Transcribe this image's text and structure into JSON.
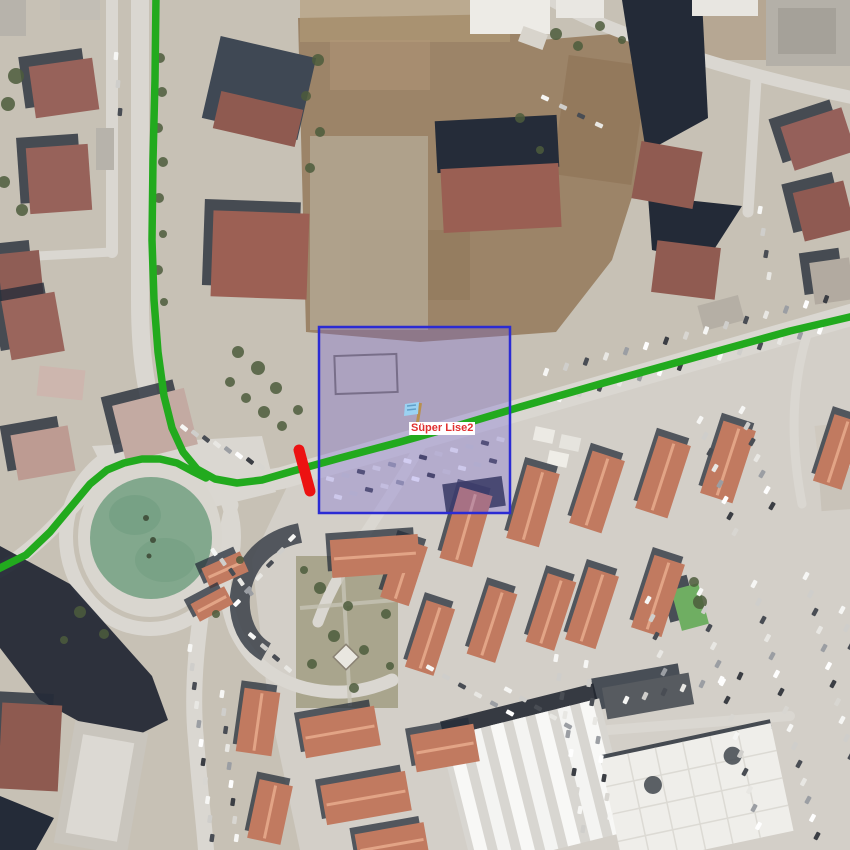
{
  "map": {
    "marker": {
      "label_text": "Süper Lise2",
      "label_text_color": "#e03030",
      "label_bg_color": "#ffffff",
      "flag_color": "#9bd2f2",
      "flag_shade_color": "#5f9fc8",
      "pole_color": "#b8904e"
    },
    "route": {
      "color": "#22aa1e",
      "width": 7.5,
      "main_points": "156,-4 155,80 153,160 152,240 154,300 158,352 164,396 172,428 183,452 197,469 215,479 237,483 262,480 293,471 340,458 400,442 460,425 520,407 600,384 700,356 790,331 854,316",
      "branch_points": "-4,570 26,555 50,532 70,508 90,484 107,470 124,463 142,459 160,459 177,463 192,471 206,478"
    },
    "selection_box": {
      "x": 319,
      "y": 327,
      "width": 191,
      "height": 186,
      "border_color": "#2b2bd4",
      "border_width": 2.5,
      "fill_color": "rgba(108,94,214,0.30)"
    },
    "blocked_segment": {
      "x1": 299,
      "y1": 450,
      "x2": 310,
      "y2": 491,
      "color": "#ec1212",
      "width": 11
    },
    "pond_color": "#82a88d"
  },
  "scene": {
    "shadow_color": "#262d3a",
    "tree_color": "#4c5c3c",
    "townhouse_color": "#c17a60",
    "townhouse_ridge_color": "#e2a486",
    "car_colors": [
      "#f6f6f4",
      "#cfcecb",
      "#494d54",
      "#e8e7e3",
      "#9b9ea3",
      "#fefefe",
      "#3b3e44",
      "#d8d6d1"
    ],
    "buildings": [
      [
        32,
        62,
        64,
        52,
        -8,
        "#97625a",
        1
      ],
      [
        28,
        146,
        62,
        66,
        -4,
        "#97625a",
        1
      ],
      [
        0,
        252,
        42,
        58,
        -6,
        "#8f5d55",
        1
      ],
      [
        6,
        296,
        54,
        60,
        -10,
        "#9a655c",
        1
      ],
      [
        96,
        128,
        18,
        42,
        0,
        "#b7b3ab",
        0
      ],
      [
        0,
        0,
        26,
        36,
        0,
        "#b7b3ab",
        0
      ],
      [
        60,
        0,
        40,
        20,
        0,
        "#c2beb5",
        0
      ],
      [
        210,
        46,
        98,
        84,
        13,
        "#3f4854",
        0
      ],
      [
        216,
        100,
        84,
        38,
        13,
        "#8f5a50",
        0
      ],
      [
        212,
        212,
        96,
        86,
        2,
        "#9c6054",
        1
      ],
      [
        436,
        118,
        122,
        52,
        -3,
        "#252c39",
        0
      ],
      [
        442,
        166,
        118,
        64,
        -3,
        "#9a5f53",
        0
      ],
      [
        470,
        0,
        80,
        34,
        0,
        "#edebe6",
        0
      ],
      [
        556,
        0,
        48,
        18,
        0,
        "#e9e7e2",
        0
      ],
      [
        692,
        0,
        66,
        16,
        0,
        "#e8e6e1",
        0
      ],
      [
        520,
        30,
        26,
        16,
        20,
        "#d8d4cc",
        0
      ],
      [
        766,
        0,
        84,
        66,
        0,
        "#b4b0a8",
        0
      ],
      [
        778,
        8,
        58,
        46,
        0,
        "#a5a199",
        0
      ],
      [
        636,
        146,
        62,
        58,
        10,
        "#905b51",
        0
      ],
      [
        654,
        244,
        64,
        52,
        7,
        "#905b51",
        0
      ],
      [
        786,
        116,
        64,
        46,
        -18,
        "#95605a",
        1
      ],
      [
        798,
        186,
        52,
        50,
        -14,
        "#8f5a52",
        1
      ],
      [
        812,
        260,
        40,
        42,
        -8,
        "#b2aaa0",
        1
      ],
      [
        816,
        424,
        36,
        30,
        -6,
        "#cfc9bf",
        0
      ],
      [
        820,
        468,
        32,
        42,
        -4,
        "#c9c3b9",
        0
      ],
      [
        700,
        300,
        42,
        26,
        -15,
        "#b5afa5",
        0
      ],
      [
        118,
        396,
        74,
        58,
        -14,
        "#c3aaa2",
        1
      ],
      [
        14,
        430,
        58,
        46,
        -10,
        "#bd9b92",
        1
      ],
      [
        38,
        368,
        46,
        30,
        6,
        "#cdb6ae",
        0
      ],
      [
        0,
        704,
        60,
        86,
        3,
        "#8e5a50",
        1
      ],
      [
        64,
        726,
        74,
        124,
        10,
        "#c9c5bd",
        0
      ],
      [
        74,
        738,
        52,
        100,
        10,
        "#dcd9d3",
        0
      ],
      [
        604,
        680,
        88,
        32,
        -10,
        "#575b60",
        1
      ],
      [
        676,
        586,
        28,
        42,
        -15,
        "#6fae62",
        1
      ],
      [
        444,
        480,
        60,
        30,
        -8,
        "#3a4148",
        0
      ],
      [
        534,
        428,
        20,
        14,
        12,
        "#eceae4",
        0
      ],
      [
        560,
        436,
        20,
        14,
        12,
        "#e6e4de",
        0
      ],
      [
        548,
        452,
        20,
        14,
        12,
        "#efede7",
        0
      ]
    ],
    "townhouses": [
      [
        466,
        527,
        34,
        74,
        16
      ],
      [
        533,
        506,
        34,
        76,
        16
      ],
      [
        597,
        492,
        34,
        76,
        18
      ],
      [
        663,
        477,
        34,
        76,
        18
      ],
      [
        728,
        462,
        34,
        76,
        18
      ],
      [
        838,
        452,
        30,
        70,
        18
      ],
      [
        592,
        608,
        32,
        76,
        18
      ],
      [
        658,
        596,
        32,
        76,
        18
      ],
      [
        404,
        572,
        30,
        62,
        18
      ],
      [
        430,
        638,
        30,
        70,
        18
      ],
      [
        492,
        624,
        30,
        72,
        18
      ],
      [
        551,
        612,
        30,
        72,
        18
      ],
      [
        375,
        556,
        88,
        38,
        -4
      ],
      [
        340,
        732,
        76,
        40,
        -10
      ],
      [
        366,
        798,
        86,
        40,
        -10
      ],
      [
        392,
        845,
        70,
        34,
        -10
      ],
      [
        445,
        748,
        64,
        38,
        -10
      ],
      [
        258,
        722,
        36,
        64,
        8
      ],
      [
        270,
        812,
        34,
        60,
        12
      ],
      [
        225,
        570,
        42,
        22,
        -24
      ],
      [
        212,
        604,
        38,
        20,
        -28
      ]
    ],
    "trees": [
      [
        16,
        76,
        8
      ],
      [
        8,
        104,
        7
      ],
      [
        4,
        182,
        6
      ],
      [
        22,
        210,
        6
      ],
      [
        160,
        58,
        5
      ],
      [
        162,
        92,
        5
      ],
      [
        158,
        128,
        5
      ],
      [
        163,
        162,
        5
      ],
      [
        159,
        198,
        5
      ],
      [
        163,
        234,
        4
      ],
      [
        158,
        270,
        5
      ],
      [
        164,
        302,
        4
      ],
      [
        318,
        60,
        6
      ],
      [
        306,
        96,
        5
      ],
      [
        320,
        132,
        5
      ],
      [
        310,
        168,
        5
      ],
      [
        238,
        352,
        6
      ],
      [
        258,
        368,
        7
      ],
      [
        276,
        388,
        6
      ],
      [
        246,
        398,
        5
      ],
      [
        264,
        412,
        6
      ],
      [
        282,
        426,
        5
      ],
      [
        298,
        410,
        5
      ],
      [
        230,
        382,
        5
      ],
      [
        556,
        34,
        6
      ],
      [
        578,
        46,
        5
      ],
      [
        600,
        26,
        5
      ],
      [
        622,
        40,
        4
      ],
      [
        520,
        118,
        5
      ],
      [
        540,
        150,
        4
      ],
      [
        320,
        588,
        6
      ],
      [
        348,
        606,
        5
      ],
      [
        334,
        636,
        6
      ],
      [
        364,
        650,
        5
      ],
      [
        312,
        664,
        5
      ],
      [
        354,
        688,
        5
      ],
      [
        386,
        614,
        5
      ],
      [
        304,
        570,
        4
      ],
      [
        390,
        666,
        4
      ],
      [
        80,
        612,
        6
      ],
      [
        104,
        634,
        5
      ],
      [
        64,
        640,
        4
      ],
      [
        700,
        602,
        7
      ],
      [
        694,
        582,
        5
      ],
      [
        216,
        614,
        4
      ],
      [
        240,
        560,
        4
      ]
    ],
    "car_rows": [
      [
        546,
        372,
        15,
        20,
        -5.2,
        -70
      ],
      [
        560,
        398,
        14,
        20,
        -5.2,
        -70
      ],
      [
        330,
        479,
        12,
        15.5,
        -3.6,
        14
      ],
      [
        338,
        497,
        11,
        15.5,
        -3.6,
        14
      ],
      [
        184,
        428,
        8,
        11,
        5.5,
        38
      ],
      [
        214,
        552,
        5,
        9,
        10,
        55
      ],
      [
        190,
        648,
        11,
        2.2,
        19,
        -82
      ],
      [
        222,
        694,
        9,
        1.8,
        18,
        -82
      ],
      [
        700,
        592,
        14,
        4.5,
        18,
        -62
      ],
      [
        754,
        584,
        15,
        4.5,
        18,
        -62
      ],
      [
        806,
        576,
        15,
        4.5,
        18,
        -62
      ],
      [
        842,
        610,
        13,
        4.5,
        18,
        -62
      ],
      [
        556,
        658,
        10,
        3,
        19,
        -80
      ],
      [
        586,
        664,
        9,
        3,
        19,
        -80
      ],
      [
        626,
        700,
        7,
        19,
        -4,
        -65
      ],
      [
        648,
        600,
        5,
        4,
        18,
        -62
      ],
      [
        700,
        420,
        8,
        5,
        16,
        -60
      ],
      [
        742,
        410,
        7,
        5,
        16,
        -60
      ],
      [
        760,
        210,
        4,
        3,
        22,
        -80
      ],
      [
        116,
        56,
        3,
        2,
        28,
        -85
      ],
      [
        430,
        668,
        6,
        16,
        9,
        28
      ],
      [
        508,
        690,
        5,
        15,
        9,
        28
      ],
      [
        545,
        98,
        4,
        18,
        9,
        25
      ],
      [
        252,
        636,
        4,
        12,
        11,
        40
      ],
      [
        292,
        538,
        6,
        -11,
        13,
        -45
      ]
    ]
  }
}
